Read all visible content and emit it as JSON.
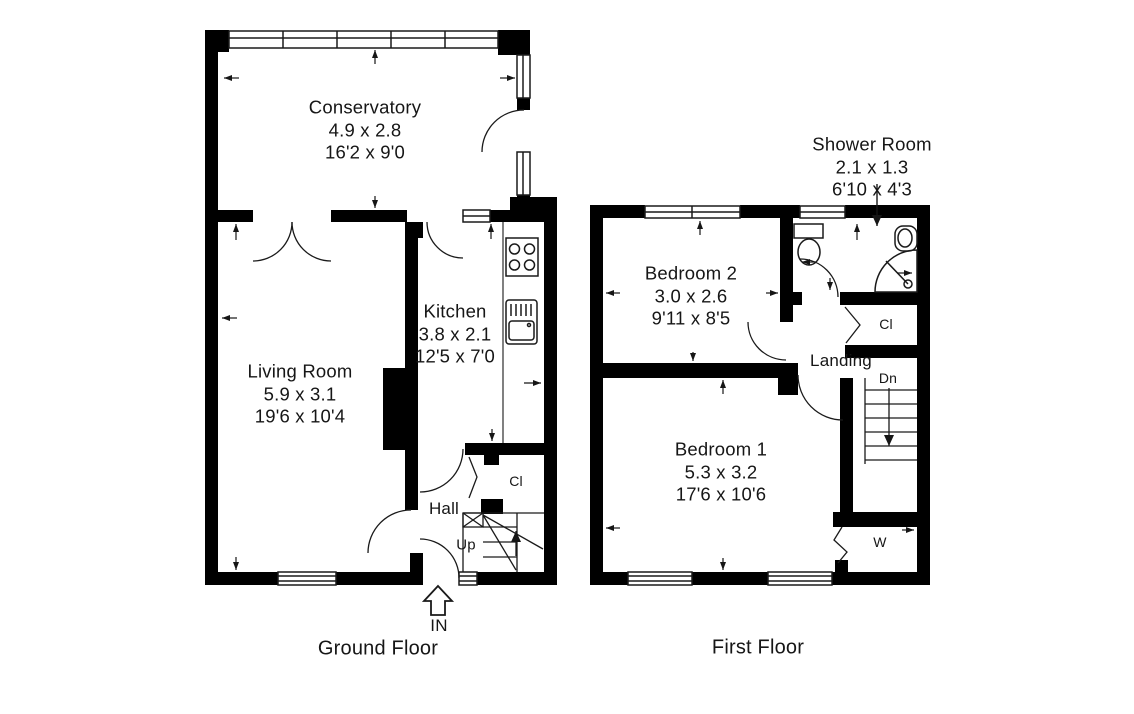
{
  "ground_floor": {
    "floor_label": "Ground Floor",
    "entrance_label": "IN",
    "stairs_label": "Up",
    "closet_label": "Cl",
    "rooms": {
      "conservatory": {
        "name": "Conservatory",
        "metric": "4.9 x 2.8",
        "imperial": "16'2 x 9'0"
      },
      "living_room": {
        "name": "Living Room",
        "metric": "5.9 x 3.1",
        "imperial": "19'6 x 10'4"
      },
      "kitchen": {
        "name": "Kitchen",
        "metric": "3.8 x 2.1",
        "imperial": "12'5 x 7'0"
      },
      "hall": {
        "name": "Hall"
      }
    }
  },
  "first_floor": {
    "floor_label": "First Floor",
    "stairs_label": "Dn",
    "closet_label": "Cl",
    "wardrobe_label": "W",
    "rooms": {
      "bedroom_2": {
        "name": "Bedroom 2",
        "metric": "3.0 x 2.6",
        "imperial": "9'11 x 8'5"
      },
      "shower_room": {
        "name": "Shower Room",
        "metric": "2.1 x 1.3",
        "imperial": "6'10 x 4'3"
      },
      "bedroom_1": {
        "name": "Bedroom 1",
        "metric": "5.3 x 3.2",
        "imperial": "17'6 x 10'6"
      },
      "landing": {
        "name": "Landing"
      }
    }
  },
  "colors": {
    "walls": "#000000",
    "background": "#ffffff",
    "lines": "#1a1a1a"
  }
}
